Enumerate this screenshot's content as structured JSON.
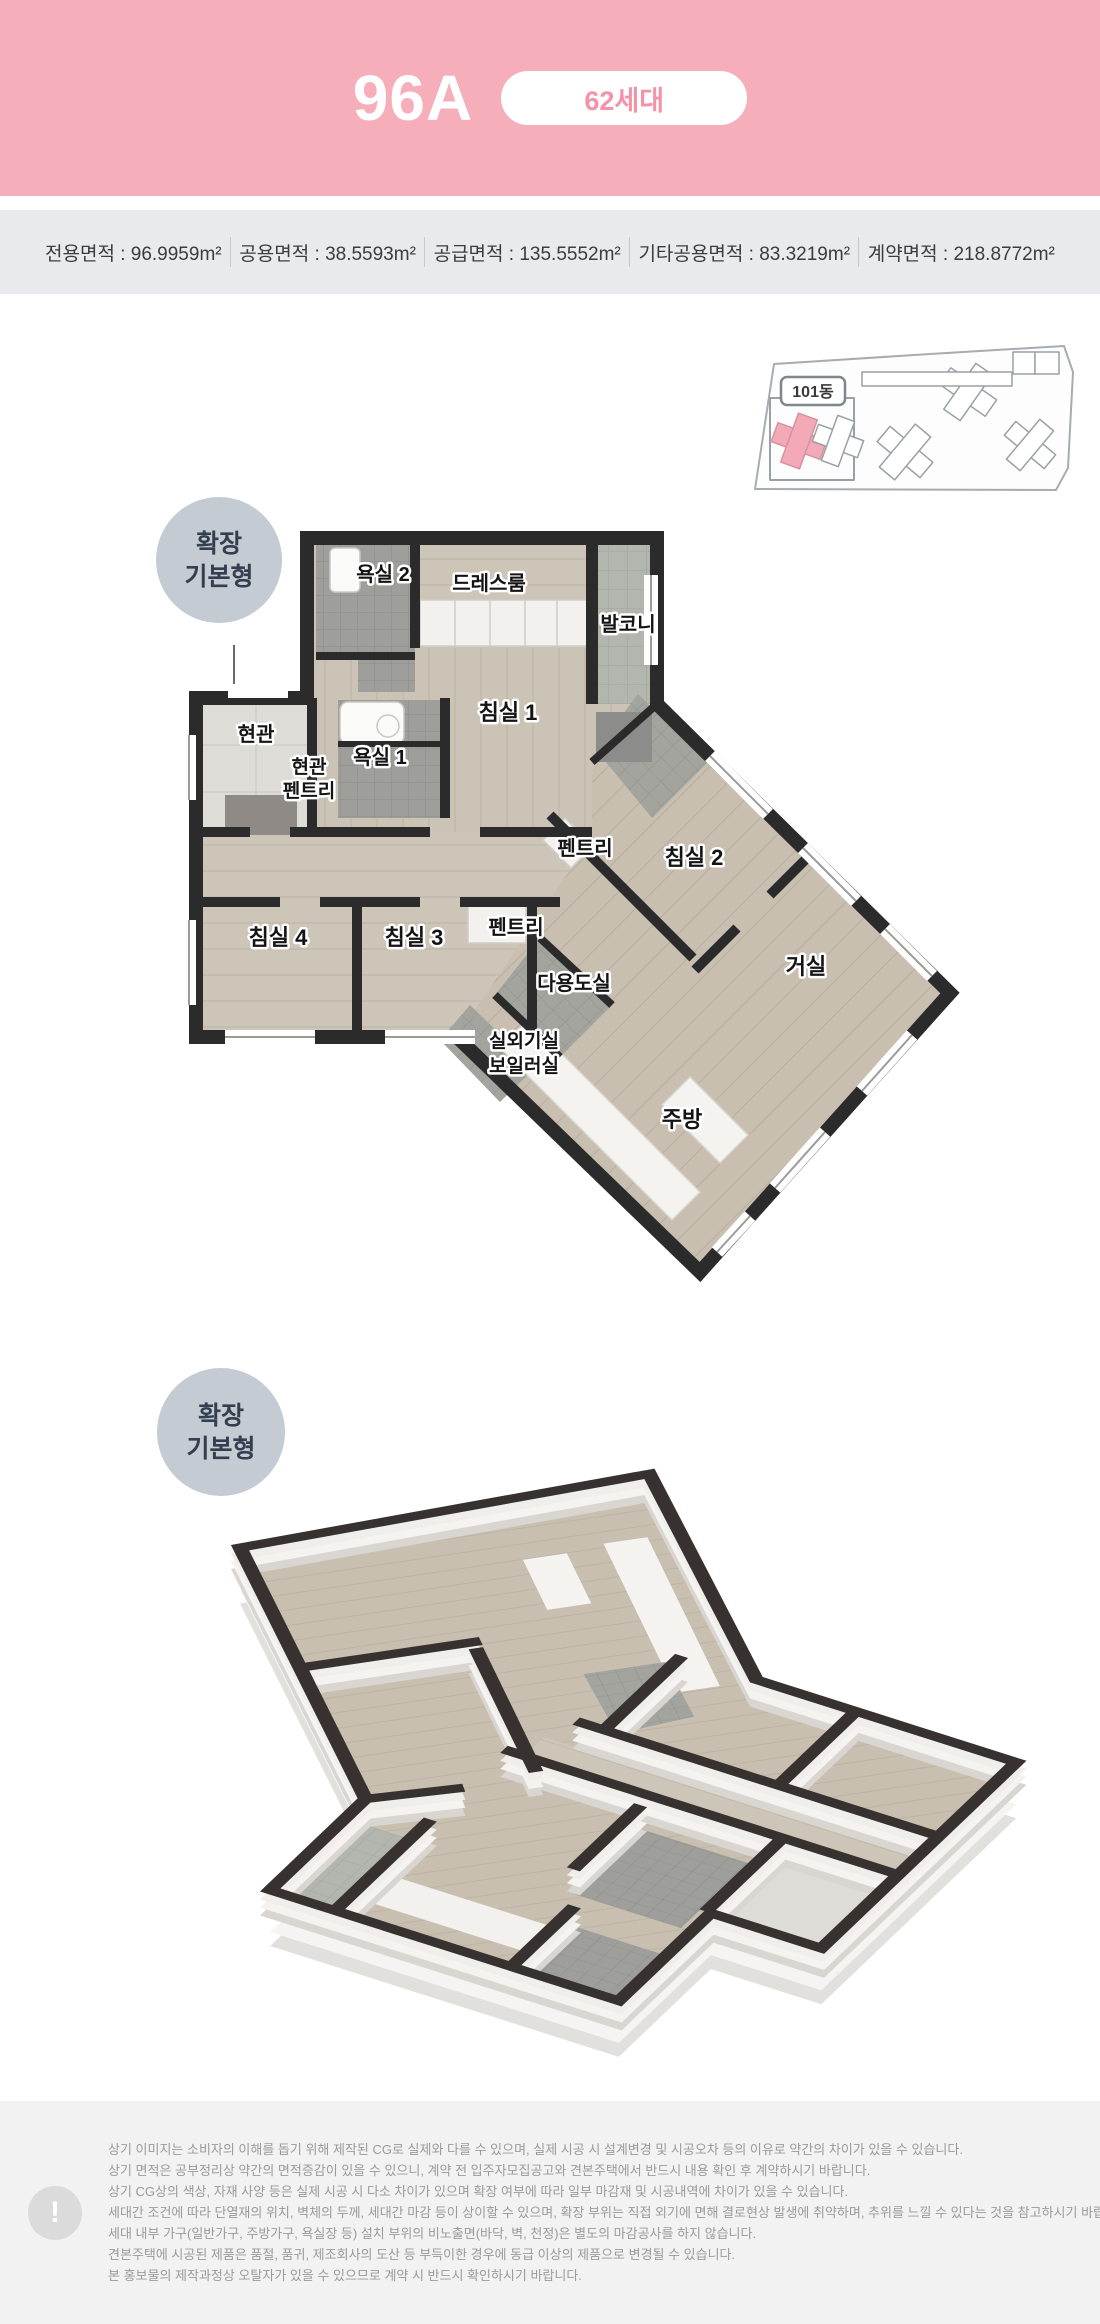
{
  "header": {
    "unit_name": "96A",
    "badge_label": "62세대"
  },
  "area_bar": {
    "separator": " : ",
    "items": [
      {
        "label": "전용면적",
        "value": "96.9959m²"
      },
      {
        "label": "공용면적",
        "value": "38.5593m²"
      },
      {
        "label": "공급면적",
        "value": "135.5552m²"
      },
      {
        "label": "기타공용면적",
        "value": "83.3219m²"
      },
      {
        "label": "계약면적",
        "value": "218.8772m²"
      }
    ]
  },
  "site_plan": {
    "building_badge": "101동"
  },
  "plan_badge": {
    "line1": "확장",
    "line2": "기본형"
  },
  "iso_badge": {
    "line1": "확장",
    "line2": "기본형"
  },
  "floor_plan": {
    "rooms": {
      "bath2": "욕실 2",
      "dressroom": "드레스룸",
      "balcony": "발코니",
      "entrance": "현관",
      "entrance_pantry_line1": "현관",
      "entrance_pantry_line2": "펜트리",
      "bath1": "욕실 1",
      "bed1": "침실 1",
      "pantry_a": "펜트리",
      "bed2": "침실 2",
      "bed4": "침실 4",
      "bed3": "침실 3",
      "pantry_b": "펜트리",
      "utility": "다용도실",
      "outdoor_unit": "실외기실",
      "boiler": "보일러실",
      "living": "거실",
      "kitchen": "주방"
    }
  },
  "disclaimer": {
    "icon_glyph": "!",
    "lines": [
      "상기 이미지는 소비자의 이해를 돕기 위해 제작된 CG로 실제와 다를 수 있으며, 실제 시공 시 설계변경 및 시공오차 등의 이유로 약간의 차이가 있을 수 있습니다.",
      "상기 면적은 공부정리상 약간의 면적증감이 있을 수 있으니, 계약 전 입주자모집공고와 견본주택에서 반드시 내용 확인 후 계약하시기 바랍니다.",
      "상기 CG상의 색상, 자재 사양 등은 실제 시공 시 다소 차이가 있으며 확장 여부에 따라 일부 마감재 및 시공내역에 차이가 있을 수 있습니다.",
      "세대간 조건에 따라 단열재의 위치, 벽체의 두께, 세대간 마감 등이 상이할 수 있으며, 확장 부위는 직접 외기에 면해 결로현상 발생에 취약하며, 추위를 느낄 수 있다는 것을 참고하시기 바랍니다.",
      "세대 내부 가구(일반가구, 주방가구, 욕실장 등) 설치 부위의 비노출면(바닥, 벽, 천정)은 별도의 마감공사를 하지 않습니다.",
      "견본주택에 시공된 제품은 품절, 품귀, 제조회사의 도산 등 부득이한 경우에 동급 이상의 제품으로 변경될 수 있습니다.",
      "본 홍보물의 제작과정상 오탈자가 있을 수 있으므로 계약 시 반드시 확인하시기 바랍니다."
    ]
  },
  "colors": {
    "header_bg": "#F6AFBA",
    "header_badge_text": "#F493A7",
    "area_bar_bg": "#E9EAEE",
    "badge_circle": "#C5CBD2",
    "badge_text": "#333E4F",
    "wall": "#2B2B2B",
    "floor_wood": "#CBC3B5",
    "tile_dark": "#9E9E9A",
    "tile_light": "#B3B6AE",
    "site_unit_pink": "#F4A9B6",
    "disclaimer_bg": "#F2F2F3",
    "disclaimer_text": "#9A9A9A"
  }
}
